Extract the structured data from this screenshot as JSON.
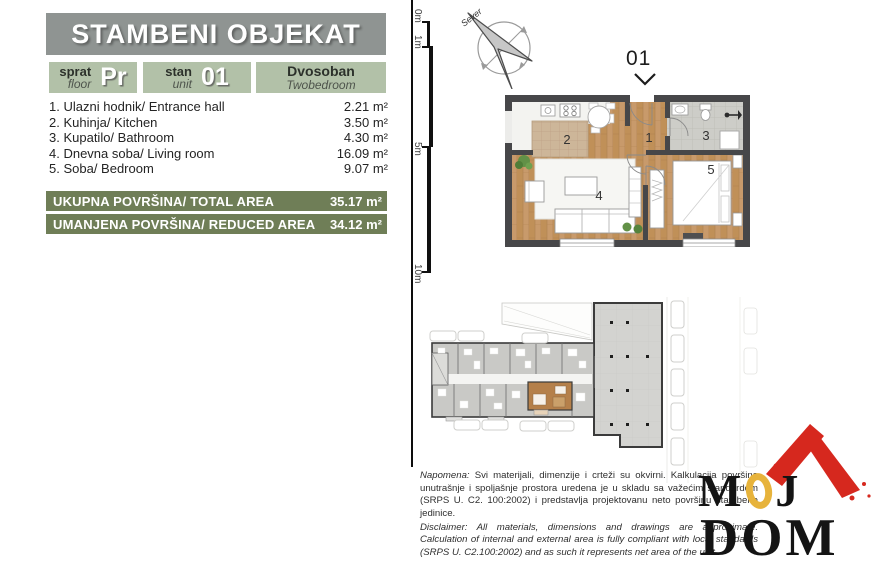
{
  "header": {
    "title": "STAMBENI OBJEKAT"
  },
  "info_boxes": {
    "floor": {
      "label_sr": "sprat",
      "label_en": "floor",
      "value": "Pr"
    },
    "unit": {
      "label_sr": "stan",
      "label_en": "unit",
      "value": "01"
    },
    "type": {
      "label_sr": "Dvosoban",
      "label_en": "Twobedroom"
    }
  },
  "rooms": [
    {
      "label": "1. Ulazni hodnik/ Entrance hall",
      "area": "2.21 m²"
    },
    {
      "label": "2. Kuhinja/ Kitchen",
      "area": "3.50 m²"
    },
    {
      "label": "3. Kupatilo/ Bathroom",
      "area": "4.30 m²"
    },
    {
      "label": "4. Dnevna soba/ Living room",
      "area": "16.09 m²"
    },
    {
      "label": "5. Soba/ Bedroom",
      "area": "9.07 m²"
    }
  ],
  "totals": [
    {
      "label": "UKUPNA POVRŠINA/ TOTAL AREA",
      "value": "35.17 m²"
    },
    {
      "label": "UMANJENA POVRŠINA/ REDUCED AREA",
      "value": "34.12 m²"
    }
  ],
  "plan": {
    "compass_label": "Sever",
    "unit_label": "01",
    "scale_marks": [
      "0m",
      "1m",
      "5m",
      "10m"
    ],
    "room_numbers": [
      "1",
      "2",
      "3",
      "4",
      "5"
    ]
  },
  "disclaimer": {
    "sr_lead": "Napomena:",
    "sr_text": " Svi materijali, dimenzije i crteži su okvirni. Kalkulacija površina unutrašnje i spoljašnje prostora uredena je u skladu sa važećim standardom (SRPS U. C2. 100:2002) i predstavlja projektovanu neto površinu stambene jedinice.",
    "en_lead": "Disclaimer:",
    "en_text": " All materials, dimensions and drawings are approximate. Calculation of internal and external area is fully compliant with local standards (SRPS U. C2.100:2002) and as such it represents net area of the unit."
  },
  "logo": {
    "m": "M",
    "o": "O",
    "j": "J",
    "dom": "DOM"
  },
  "colors": {
    "header_gray": "#8f9492",
    "light_green": "#b2c1a8",
    "dark_green": "#6f7e57",
    "wood": "#c89a6b",
    "wall": "#474749",
    "highlight_brown": "#b5804a",
    "logo_red": "#d6281e",
    "logo_yellow": "#e7b33b"
  }
}
